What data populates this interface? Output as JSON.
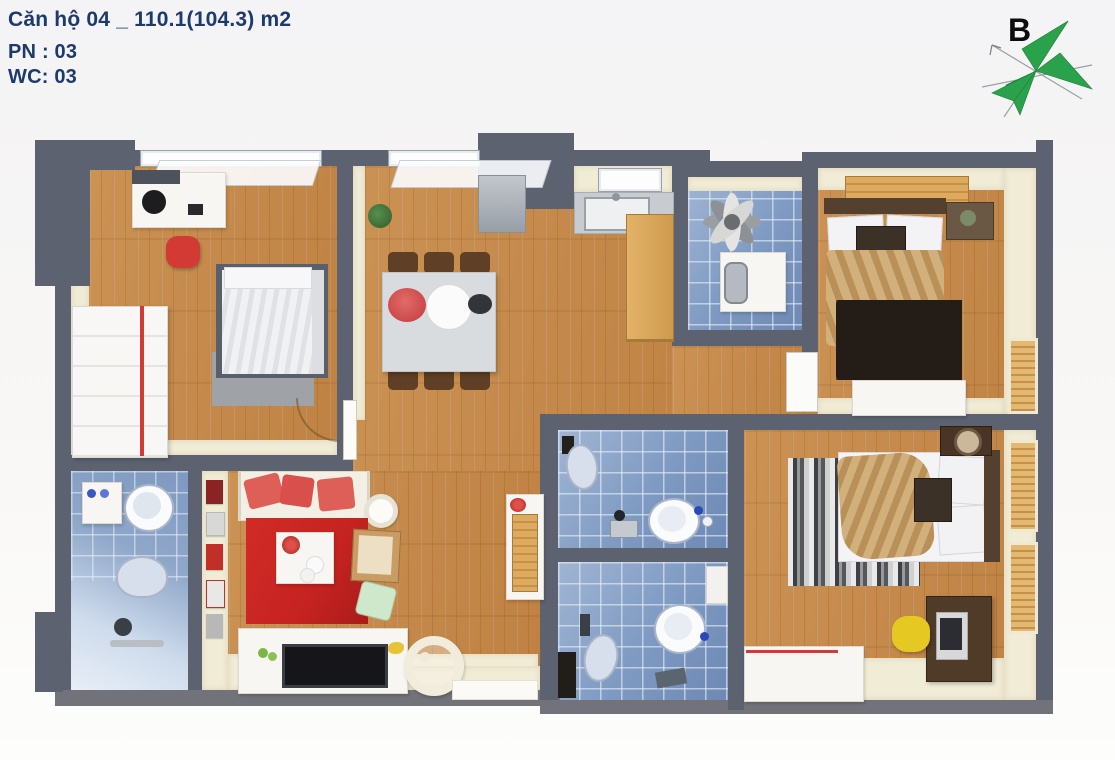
{
  "header": {
    "title": "Căn hộ 04 _ 110.1(104.3) m2",
    "bedrooms": "PN : 03",
    "toilets": "WC: 03"
  },
  "compass": {
    "label": "B"
  },
  "icons": {
    "compass": "compass-rose-icon"
  },
  "colors": {
    "ink": "#1c3a6b",
    "bg_top": "#f4f3f5",
    "bg_bottom": "#fdfdfc",
    "wall": "#5c6270",
    "wall_light": "#72737a",
    "cream": "#f1ecd6",
    "wood_a": "#cb9254",
    "wood_b": "#bf8243",
    "wood_light": "#ddab60",
    "tile_a": "#a0b5d3",
    "tile_b": "#6d89b4",
    "accent_red": "#d23a33",
    "rug_red": "#c52321",
    "pillow_coral": "#dd5f58",
    "compass_green": "#2aa24c",
    "tan": "#c7a26d",
    "dark_wood": "#53402e",
    "yellow_chair": "#e5c822"
  }
}
